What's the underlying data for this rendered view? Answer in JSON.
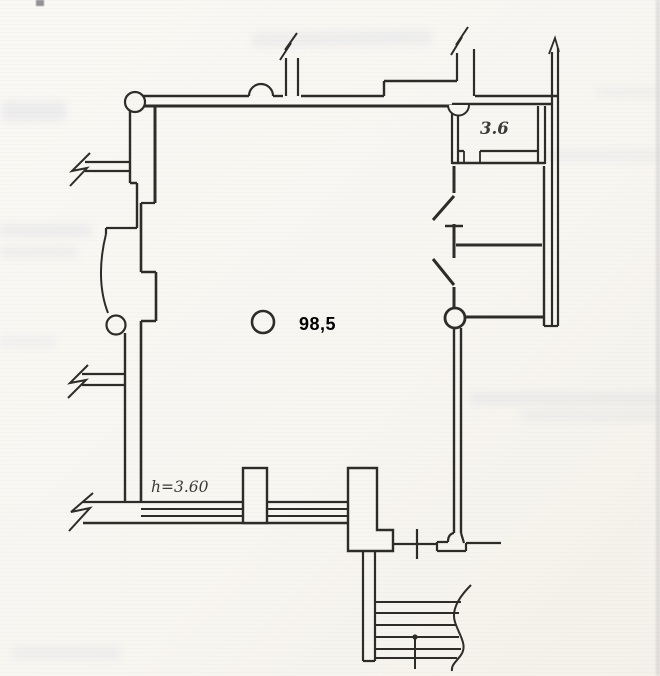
{
  "colors": {
    "paper": "#f8f6f1",
    "ink": "#2e2c29",
    "area_text": "#000000",
    "scan_text": "#3c3a38",
    "bleed": "#93a0c4"
  },
  "plan": {
    "main_room_area": "98,5",
    "small_room_area": "3.6",
    "ceiling_height_note": "h=3.60"
  }
}
